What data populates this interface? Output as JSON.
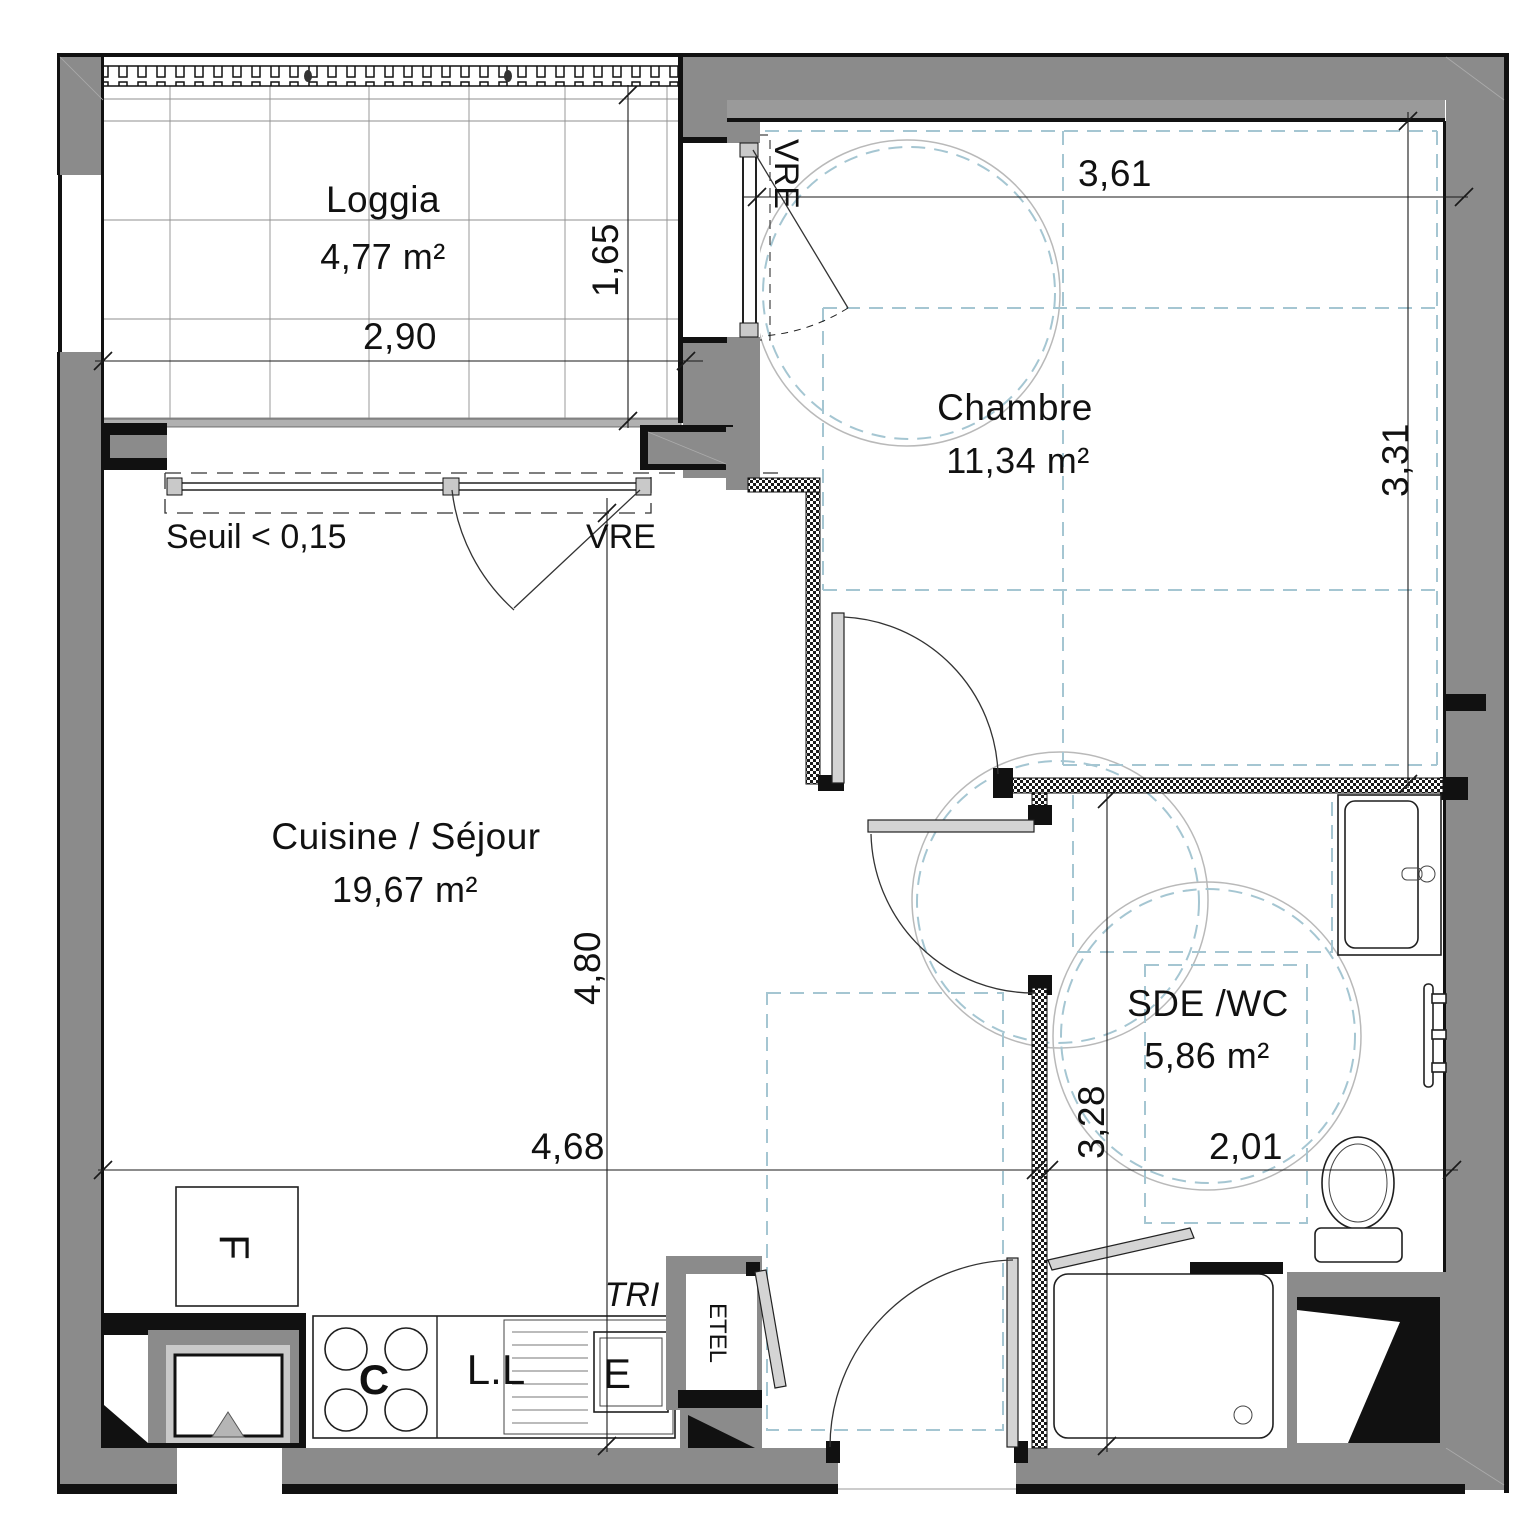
{
  "rooms": {
    "loggia": {
      "name": "Loggia",
      "area": "4,77 m²"
    },
    "chambre": {
      "name": "Chambre",
      "area": "11,34 m²"
    },
    "cuisine": {
      "name": "Cuisine / Séjour",
      "area": "19,67 m²"
    },
    "sde": {
      "name": "SDE /WC",
      "area": "5,86 m²"
    }
  },
  "dimensions": {
    "loggia_width": "2,90",
    "loggia_depth": "1,65",
    "chambre_width": "3,61",
    "chambre_depth": "3,31",
    "cuisine_depth": "4,80",
    "cuisine_width": "4,68",
    "sde_depth": "3,28",
    "sde_width": "2,01",
    "seuil": "Seuil < 0,15"
  },
  "labels": {
    "vre_loggia": "VRE",
    "vre_chambre": "VRE",
    "tri": "TRI",
    "etel": "ETEL",
    "fridge": "F",
    "cooktop": "C",
    "washing_machine": "L.L",
    "sink": "E"
  },
  "colors": {
    "wall_gray": "#8b8b8b",
    "clearance_blue": "#a5c6d2",
    "line_black": "#111111"
  }
}
